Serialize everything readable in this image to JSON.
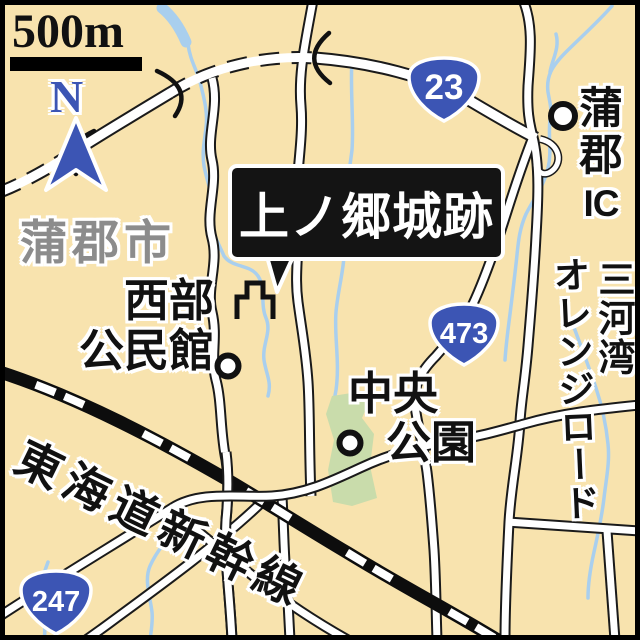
{
  "map_title": "上ノ郷城跡",
  "scale_bar": {
    "label": "500m"
  },
  "compass": {
    "label": "N"
  },
  "city_label": "蒲郡市",
  "pois": {
    "seibu_community_center": {
      "line1": "西部",
      "line2": "公民館"
    },
    "chuo_park": {
      "line1": "中央",
      "line2": "公園"
    },
    "gamagori_ic": {
      "char1": "蒲",
      "char2": "郡",
      "char3": "IC"
    }
  },
  "roads": {
    "mikawa_bay": "三河湾",
    "orange_road": "オレンジロード",
    "shinkansen": "東海道新幹線"
  },
  "route_shields": {
    "route23": "23",
    "route473": "473",
    "route247": "247"
  },
  "colors": {
    "background": "#f8e3ae",
    "route_shield_blue": "#3c55b4",
    "stream_blue": "#a9cfee",
    "park_green": "#c9dcab",
    "city_text_gray": "#8c8c8c",
    "road_fill": "#ffffff",
    "line_black": "#1a1a1a"
  }
}
